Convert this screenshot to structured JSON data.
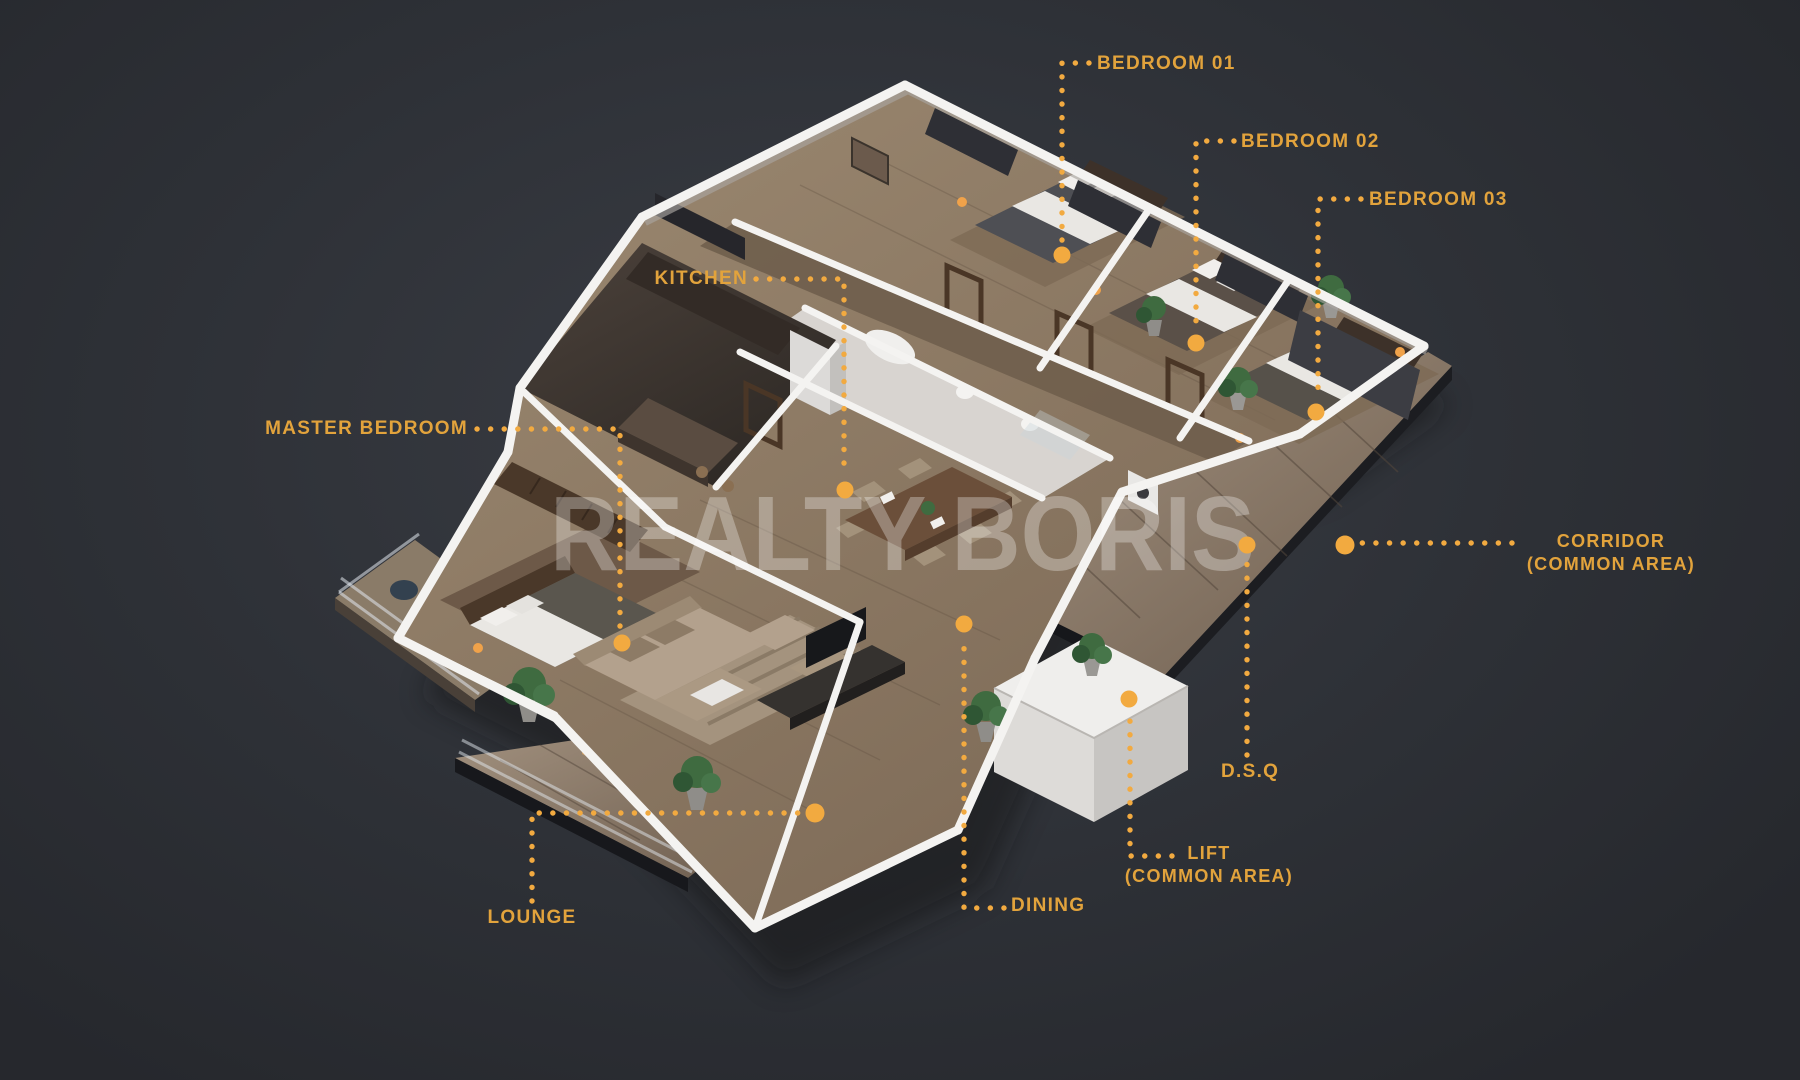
{
  "watermark": {
    "text": "REALTY BORIS"
  },
  "labels": {
    "bedroom_01": {
      "text": "BEDROOM 01"
    },
    "bedroom_02": {
      "text": "BEDROOM 02"
    },
    "bedroom_03": {
      "text": "BEDROOM 03"
    },
    "kitchen": {
      "text": "KITCHEN"
    },
    "master_bedroom": {
      "text": "MASTER BEDROOM"
    },
    "corridor": {
      "line1": "CORRIDOR",
      "line2": "(COMMON AREA)"
    },
    "dsq": {
      "text": "D.S.Q"
    },
    "lift": {
      "line1": "LIFT",
      "line2": "(COMMON AREA)"
    },
    "dining": {
      "text": "DINING"
    },
    "lounge": {
      "text": "LOUNGE"
    }
  },
  "colors": {
    "background": "#2E3137",
    "accent_gold_dots": "#F2AA40",
    "label_gold_text": "#E2A33C",
    "wall_white": "#F2F1EF",
    "wood_floor": "#97856C",
    "deck_wood": "#8F7E6C",
    "kitchen_dark_tile": "#443B35",
    "bath_light_tile": "#D8D4D0",
    "watermark_white": "rgba(255,255,255,0.30)"
  },
  "scene": {
    "type": "isometric-3d-floor-plan",
    "rooms": [
      "Bedroom 01",
      "Bedroom 02",
      "Bedroom 03",
      "Kitchen",
      "Master Bedroom",
      "Corridor (Common Area)",
      "D.S.Q",
      "Lift (Common Area)",
      "Dining",
      "Lounge"
    ]
  }
}
